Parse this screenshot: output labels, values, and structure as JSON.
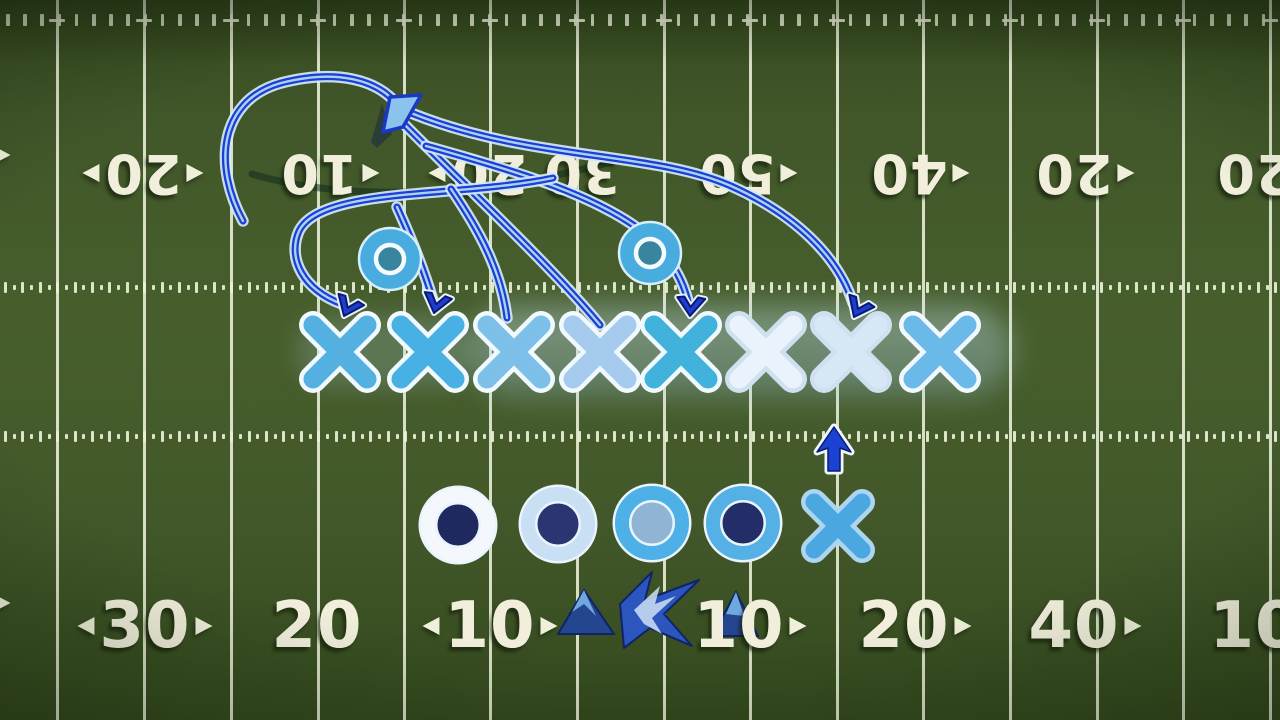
{
  "scene": {
    "description": "football play diagram on green field",
    "accent_route_color": "#1d3fd6",
    "accent_light": "#d3e9fa"
  },
  "field": {
    "line_color": "#ecf1db",
    "yard_line_xs": [
      57,
      144,
      231,
      318,
      404,
      490,
      577,
      664,
      750,
      837,
      923,
      1010,
      1097,
      1183,
      1270
    ],
    "boundary_ticks": {
      "y": 20,
      "height": 12,
      "width": 3.5,
      "spacing": 17.2,
      "crossbar_y": 20,
      "crossbar_w": 16,
      "crossbar_h": 3
    },
    "hash_rows": [
      {
        "y": 287,
        "tall": 11,
        "short": 5,
        "width": 3,
        "spacing": 8.7
      },
      {
        "y": 436,
        "tall": 11,
        "short": 5,
        "width": 3,
        "spacing": 8.7
      }
    ],
    "top_numbers": [
      {
        "x": 2,
        "label": "",
        "left_arrow": false,
        "right_arrow": true
      },
      {
        "x": 143,
        "label": "20",
        "left_arrow": true,
        "right_arrow": true
      },
      {
        "x": 330,
        "label": "10",
        "left_arrow": false,
        "right_arrow": true
      },
      {
        "x": 478,
        "label": "20",
        "left_arrow": true,
        "right_arrow": false
      },
      {
        "x": 582,
        "label": "30",
        "left_arrow": false,
        "right_arrow": false
      },
      {
        "x": 748,
        "label": "50",
        "left_arrow": false,
        "right_arrow": true
      },
      {
        "x": 920,
        "label": "40",
        "left_arrow": false,
        "right_arrow": true
      },
      {
        "x": 1085,
        "label": "20",
        "left_arrow": false,
        "right_arrow": true
      },
      {
        "x": 1255,
        "label": "20",
        "left_arrow": false,
        "right_arrow": false
      }
    ],
    "bottom_numbers": [
      {
        "x": 2,
        "label": "",
        "left_arrow": false,
        "right_arrow": true
      },
      {
        "x": 145,
        "label": "30",
        "left_arrow": true,
        "right_arrow": true
      },
      {
        "x": 317,
        "label": "20",
        "left_arrow": false,
        "right_arrow": false
      },
      {
        "x": 490,
        "label": "10",
        "left_arrow": true,
        "right_arrow": true
      },
      {
        "x": 750,
        "label": "10",
        "left_arrow": false,
        "right_arrow": true
      },
      {
        "x": 915,
        "label": "20",
        "left_arrow": false,
        "right_arrow": true
      },
      {
        "x": 1085,
        "label": "40",
        "left_arrow": false,
        "right_arrow": true
      },
      {
        "x": 1255,
        "label": "10",
        "left_arrow": false,
        "right_arrow": false
      }
    ],
    "top_numbers_rotated": true,
    "number_rows_y": {
      "top": 146,
      "bottom": 594
    }
  },
  "logo": {
    "name": "blue-mountain-star-emblem",
    "primary": "#24468f",
    "mid": "#2c55bd",
    "accent": "#6fa8dc",
    "highlight": "#cfe2f4",
    "outline": "#0f2466",
    "left_mountain": "558,634 584,590 614,634",
    "left_mountain_face": "572,612 584,590 596,616 584,604",
    "star": "620,604 652,572 645,600 699,580 664,614 692,646 650,628 624,648",
    "star_highlight": "634,610 660,586 655,604 676,596 652,618 662,634 644,624",
    "right_mountain": "712,636 736,592 758,636",
    "right_mountain_face": "726,614 736,592 744,616"
  },
  "shadow_arc": {
    "d": "M 252,174 C 360,206 500,192 612,162",
    "color": "rgba(12,40,28,0.5)",
    "width": 7
  },
  "routes": [
    {
      "name": "curl-loop",
      "d": "M 243,221 C 214,168 217,101 281,83 C 336,69 379,79 399,107"
    },
    {
      "name": "slant-to-x4",
      "d": "M 401,121 C 465,186 551,266 600,325"
    },
    {
      "name": "deep-arc-to-x7",
      "d": "M 411,113 C 530,161 652,151 731,186 C 796,215 838,257 853,303"
    },
    {
      "name": "arc-to-x5",
      "d": "M 426,146 C 520,172 601,197 648,236 C 674,261 685,285 689,306"
    },
    {
      "name": "oval-around-o-to-x1",
      "d": "M 553,178 C 456,198 321,187 299,231 C 287,258 303,290 342,304"
    },
    {
      "name": "strand-to-x2",
      "d": "M 397,207 C 414,244 425,274 433,300"
    },
    {
      "name": "strand-to-x3",
      "d": "M 451,189 C 479,230 501,270 507,318"
    }
  ],
  "route_style": {
    "halo": "#d3e9fa",
    "main": "#1d3fd6",
    "center": "#a9d2f2"
  },
  "pennant": {
    "shadow_points": "371,142 382,104 392,134 377,148",
    "points": "383,132 390,97 421,95 403,127",
    "fill": "#8cc3ec",
    "stroke": "#1a38c8"
  },
  "players": {
    "x_row_y": 352,
    "x_row": [
      {
        "x": 340,
        "color": "#55b0e2",
        "outline": "#f2f9fe"
      },
      {
        "x": 428,
        "color": "#49b0e4",
        "outline": "#f2f9fe"
      },
      {
        "x": 514,
        "color": "#7cc0ea",
        "outline": "#f2f9fe"
      },
      {
        "x": 600,
        "color": "#a4cbee",
        "outline": "#f2f9fe"
      },
      {
        "x": 681,
        "color": "#41b2dc",
        "outline": "#f2f9fe"
      },
      {
        "x": 766,
        "color": "#eaf2fb",
        "outline": "#cfe0f0"
      },
      {
        "x": 851,
        "color": "#d8e7f5",
        "outline": "#cfe0f0"
      },
      {
        "x": 940,
        "color": "#6ab9e8",
        "outline": "#f2f9fe"
      }
    ],
    "o_upper": [
      {
        "x": 390,
        "y": 259
      },
      {
        "x": 650,
        "y": 253
      }
    ],
    "o_upper_style": {
      "disc": "#48acde",
      "rim": "#d8eefa",
      "inner_ring": "#f4fafe"
    },
    "o_lower": [
      {
        "x": 458,
        "y": 525,
        "ring": "#f4f8fd",
        "hole": "#20295f"
      },
      {
        "x": 558,
        "y": 524,
        "ring": "#c9dff3",
        "hole": "#2a3572"
      },
      {
        "x": 652,
        "y": 523,
        "ring": "#4db0e6",
        "hole": "#8fb4d4"
      },
      {
        "x": 743,
        "y": 523,
        "ring": "#55b0e6",
        "hole": "#232e68"
      }
    ],
    "o_lower_style": {
      "outer_rim": "#eaf4fc"
    },
    "x_lower": {
      "x": 838,
      "y": 526,
      "color": "#4aa7e0",
      "outline": "#add5f0"
    }
  },
  "arrows": {
    "down_chevrons": [
      {
        "x": 344,
        "y": 316,
        "rot": 24
      },
      {
        "x": 434,
        "y": 313,
        "rot": 14
      },
      {
        "x": 690,
        "y": 316,
        "rot": 4
      },
      {
        "x": 854,
        "y": 317,
        "rot": 26
      }
    ],
    "chevron_fill": "#1c3ed2",
    "chevron_edge": "#0c1a6e",
    "chevron_halo": "#e8f3fc",
    "up_arrow": {
      "points": "834,427 851,452 840,448 840,471 828,471 828,448 817,452",
      "fill": "#1c42d4",
      "halo": "#eef6fd"
    }
  }
}
